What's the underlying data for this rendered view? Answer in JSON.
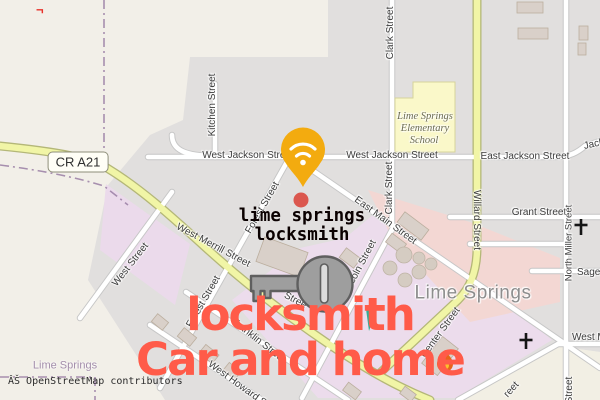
{
  "map": {
    "attribution": "ÂŠ OpenStreetMap contributors",
    "route_badge": "CR A21",
    "place_label": "Lime Springs",
    "boundary_place_label": "Lime Springs",
    "school": {
      "line1": "Lime Springs",
      "line2": "Elementary",
      "line3": "School"
    },
    "streets": {
      "clark_top": "Clark Street",
      "clark_mid": "Clark Street",
      "kitchen": "Kitchen Street",
      "west_jackson_left": "West Jackson Street",
      "west_jackson_right": "West Jackson Street",
      "east_jackson": "East Jackson Street",
      "jackson_edge": "Jackson Street",
      "east_main": "East Main Street",
      "willard": "Willard Street",
      "grant": "Grant Street",
      "north_miller": "North Miller Street",
      "sage_edge": "Sage S",
      "west_m_edge": "West M",
      "merrill": "West Merrill Street",
      "west": "West Street",
      "forest_upper": "Forest Street",
      "forest_lower": "Forest Street",
      "franklin": "Franklin Street",
      "howard": "West Howard St",
      "lincoln": "Lincoln Street",
      "center": "Center Street",
      "street_partial_key": "Stree",
      "street_partial_sw": "reet",
      "street_partial_miller": "Street"
    }
  },
  "overlay": {
    "stray_mark": "¬",
    "pin_business": {
      "line1": "lime springs",
      "line2": "locksmith"
    },
    "headline": {
      "line1": "locksmith",
      "line2": "Car and home"
    },
    "accent_color": "#ff5b49",
    "pin_color": "#f3ab0f",
    "key_color": "#9e9e9e"
  }
}
